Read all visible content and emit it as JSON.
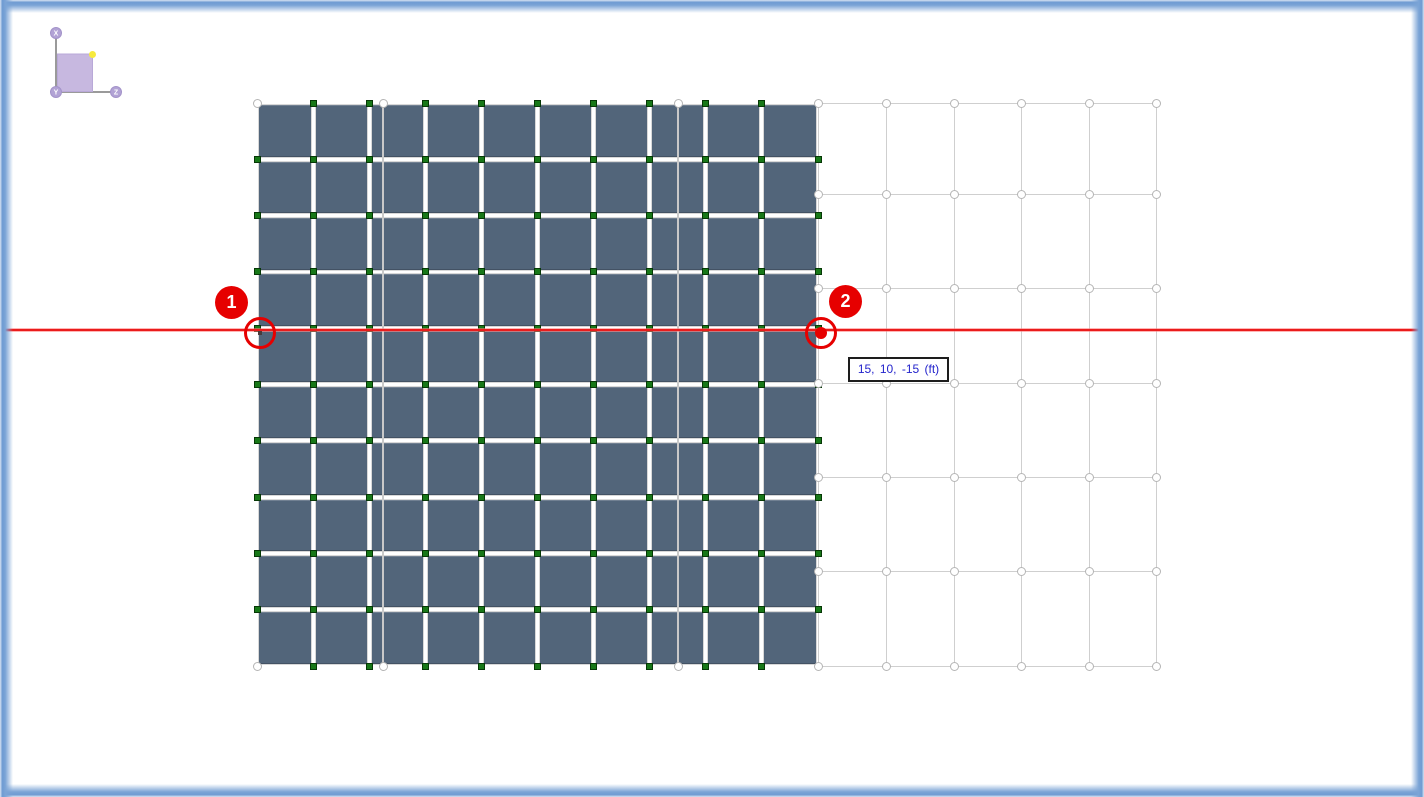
{
  "view": {
    "type": "model-viewport",
    "background": "#ffffff",
    "frame_color": "#6e9bd2"
  },
  "axis_triad": {
    "x_label": "X",
    "y_label": "Y",
    "z_label": "Z",
    "node_color": "#b2a3d5",
    "square_color": "#c7b8e0",
    "marker_color": "#f7ea3d",
    "line_color": "#9a9a9a"
  },
  "model": {
    "panel_grid": {
      "cols": 10,
      "rows": 10,
      "panel_color": "#52657a",
      "node_color": "#187818"
    },
    "reference_grid": {
      "line_color": "#cfcfcf",
      "intersection_marker": "circle",
      "right_columns": 6,
      "rows": 7
    }
  },
  "measurement": {
    "line_color": "#e60000",
    "points": [
      {
        "label": "1"
      },
      {
        "label": "2"
      }
    ],
    "tooltip": {
      "text": "15, 10, -15 (ft)",
      "text_color": "#2424cc"
    }
  }
}
